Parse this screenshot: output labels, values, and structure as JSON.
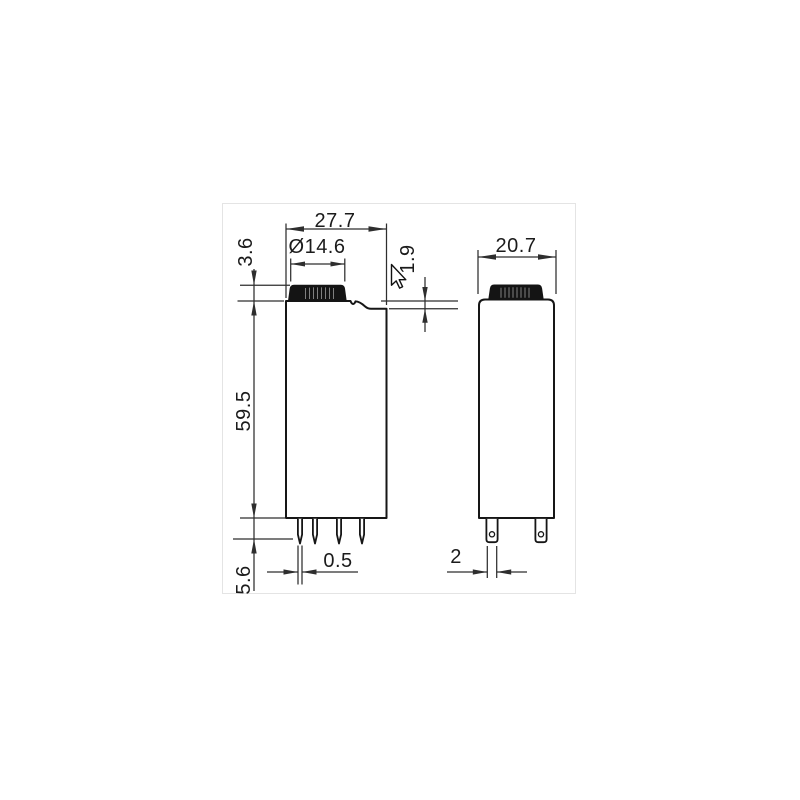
{
  "page": {
    "background": "#ffffff",
    "frame_border_color": "#e4e4e4"
  },
  "drawing": {
    "type": "technical-dimension-drawing",
    "subject": "relay-module-two-views",
    "units_implied": "mm",
    "style": {
      "outline_color": "#161616",
      "dimension_color": "#2e2e2e",
      "cap_fill": "#141414",
      "knurl_line_color": "#808080"
    },
    "front_view": {
      "dims": {
        "width": "27.7",
        "button_diameter": "Ø14.6",
        "button_height": "3.6",
        "collar_step": "1.9",
        "body_height": "59.5",
        "pin_length": "5.6",
        "pin_width": "0.5"
      }
    },
    "side_view": {
      "dims": {
        "width": "20.7",
        "blade_pin_width": "2"
      }
    },
    "cursor_icon": "mouse-pointer"
  }
}
